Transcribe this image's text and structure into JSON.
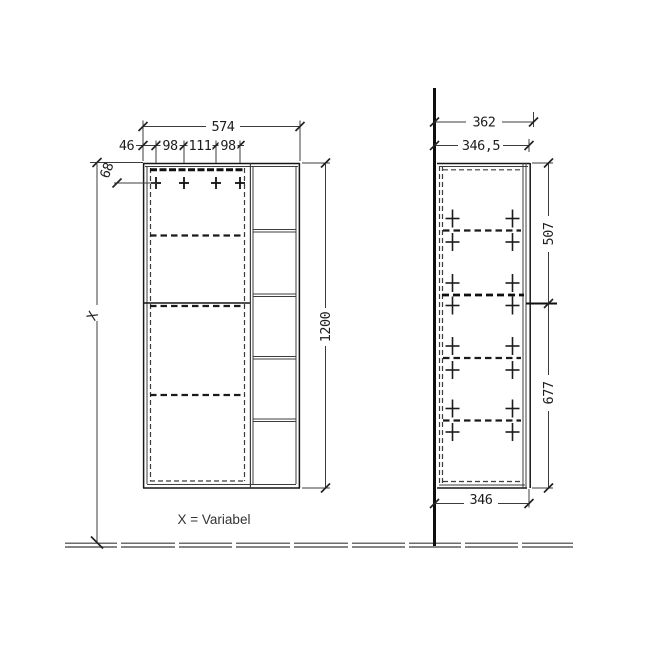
{
  "note": {
    "variable_label": "X = Variabel"
  },
  "front_view": {
    "width": "574",
    "offset_left": "46",
    "hinge_gap_1": "98",
    "hinge_gap_2": "111",
    "hinge_gap_3": "98",
    "hinge_top_offset": "68",
    "height": "1200",
    "floor_clearance": "X"
  },
  "side_view": {
    "depth_overall": "362",
    "depth_body": "346,5",
    "upper_section_height": "507",
    "lower_section_height": "677",
    "depth_bottom": "346"
  }
}
